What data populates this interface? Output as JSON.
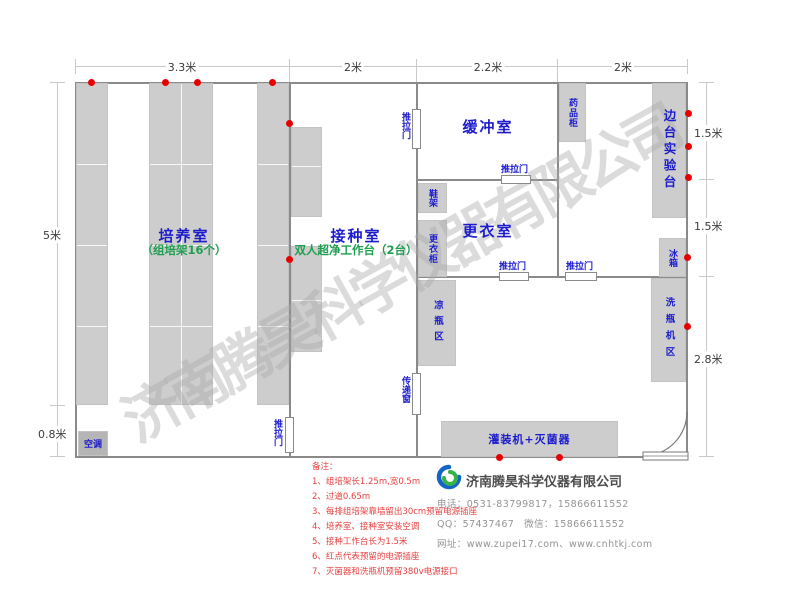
{
  "watermark": "济南腾昊科学仪器有限公司",
  "dims": {
    "top": [
      "3.3米",
      "2米",
      "2.2米",
      "2米"
    ],
    "left": [
      "5米",
      "0.8米"
    ],
    "right": [
      "1.5米",
      "1.5米",
      "2.8米"
    ]
  },
  "rooms": {
    "cultivation": {
      "name": "培养室",
      "subtitle": "（组培架16个）"
    },
    "inoculation": {
      "name": "接种室",
      "subtitle": "双人超净工作台（2台）"
    },
    "buffer": {
      "name": "缓冲室"
    },
    "changing": {
      "name": "更衣室"
    }
  },
  "furniture": {
    "ac": "空调",
    "sliding_door": "推拉门",
    "pass_window": "传递窗",
    "shoe_rack": "鞋架",
    "locker": "更衣柜",
    "cooling_area": "凉瓶区",
    "medicine_cabinet": "药品柜",
    "side_bench": "边台实验台",
    "fridge": "冰箱",
    "washer_area": "洗瓶机区",
    "filler": "灌装机+灭菌器"
  },
  "notes": {
    "title": "备注：",
    "items": [
      "1、组培架长1.25m,宽0.5m",
      "2、过道0.65m",
      "3、每排组培架靠墙留出30cm预留电源插座",
      "4、培养室、接种室安装空调",
      "5、接种工作台长为1.5米",
      "6、红点代表预留的电源插座",
      "7、灭菌器和洗瓶机预留380v电源接口"
    ]
  },
  "company": {
    "name": "济南腾昊科学仪器有限公司",
    "phone": "电话：0531-83799817，15866611552",
    "qq": "QQ：57437467　微信：15866611552",
    "website": "网址：www.zupei17.com、www.cnhtkj.com"
  },
  "colors": {
    "label_blue": "#1c1ccd",
    "note_green": "#1f9e50",
    "dot_red": "#e60000",
    "note_red": "#e64040",
    "furniture_gray": "#cdcdcd",
    "wall_gray": "#8a8a8a",
    "watermark_gray": "#c4c4c4"
  }
}
